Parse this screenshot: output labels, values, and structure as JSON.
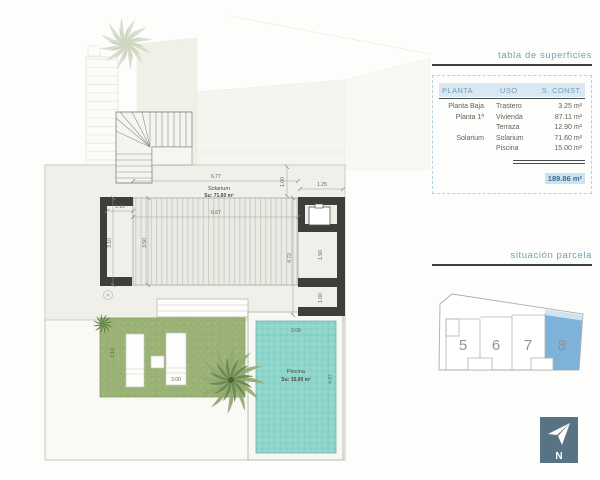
{
  "plan": {
    "solarium_label": "Solarium",
    "solarium_area": "Su: 71.60 m²",
    "pool_label": "Piscina",
    "pool_area": "Su: 15.00 m²",
    "dims": {
      "width_total": "6.77",
      "width_inner": "6.67",
      "top_right": "1.25",
      "right_top_v": "1.00",
      "left_gap": "1.10",
      "left_v1": "3.10",
      "left_v2": "3.50",
      "right_v": "4.73",
      "room_mid_v": "1.90",
      "room_low_v": "1.00",
      "pool_w": "3.08",
      "pool_h": "4.87",
      "garden_v": "3.10",
      "garden_w": "3.00"
    }
  },
  "surfaces_table": {
    "title": "tabla de superficies",
    "headers": [
      "PLANTA",
      "USO",
      "S. CONST."
    ],
    "rows": [
      {
        "planta": "Planta Baja",
        "uso": "Trastero",
        "sconst": "3.25 m²"
      },
      {
        "planta": "Planta 1ª",
        "uso": "Vivienda",
        "sconst": "87.11 m²"
      },
      {
        "planta": "",
        "uso": "Terraza",
        "sconst": "12.90 m²"
      },
      {
        "planta": "Solarium",
        "uso": "Solarium",
        "sconst": "71.60 m²"
      },
      {
        "planta": "",
        "uso": "Piscina",
        "sconst": "15.00 m²"
      }
    ],
    "total": "189.86 m²"
  },
  "parcel": {
    "title": "situación parcela",
    "plots": [
      "5",
      "6",
      "7",
      "8"
    ],
    "highlighted_plot": "8",
    "highlight_color": "#7fb2d9"
  },
  "compass": {
    "label": "N"
  }
}
